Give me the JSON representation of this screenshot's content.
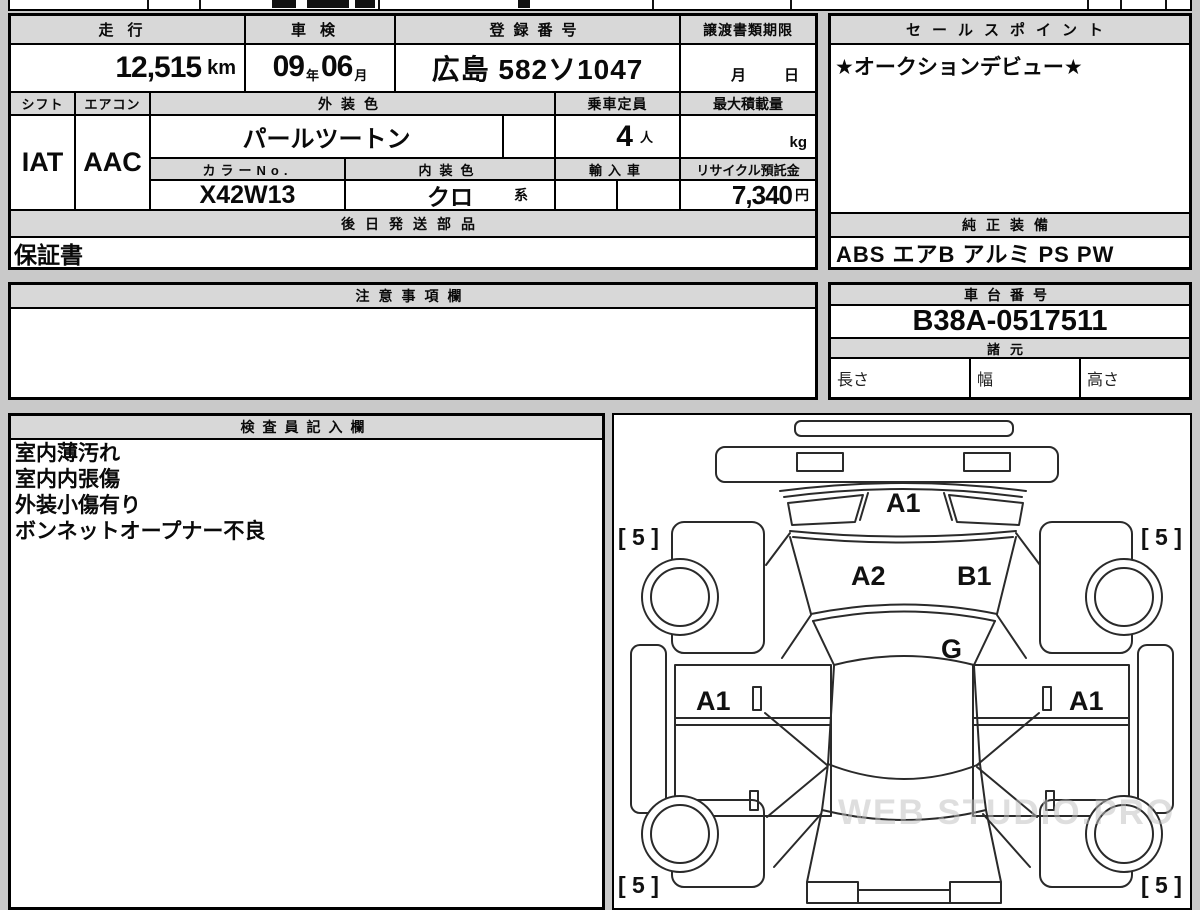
{
  "page": {
    "background": "#c9c9c9",
    "header_bg": "#d8d8d8",
    "border_color": "#000000"
  },
  "main_table": {
    "mileage_label": "走行",
    "mileage_value": "12,515",
    "mileage_unit": "km",
    "shaken_label": "車検",
    "shaken_year": "09",
    "shaken_year_unit": "年",
    "shaken_month": "06",
    "shaken_month_unit": "月",
    "registration_label": "登録番号",
    "registration_value": "広島 582ソ1047",
    "deadline_label": "譲渡書類期限",
    "deadline_month": "月",
    "deadline_day": "日",
    "shift_label": "シフト",
    "shift_value": "IAT",
    "aircon_label": "エアコン",
    "aircon_value": "AAC",
    "exterior_label": "外装色",
    "exterior_value": "パールツートン",
    "capacity_label": "乗車定員",
    "capacity_value": "4",
    "capacity_unit": "人",
    "max_load_label": "最大積載量",
    "max_load_unit": "kg",
    "color_no_label": "カラーNo.",
    "color_no_value": "X42W13",
    "interior_label": "内装色",
    "interior_value": "クロ",
    "interior_suffix": "系",
    "import_label": "輸入車",
    "recycle_label": "リサイクル預託金",
    "recycle_value": "7,340",
    "recycle_unit": "円",
    "later_parts_label": "後日発送部品",
    "later_parts_value": "保証書"
  },
  "sales": {
    "label": "セールスポイント",
    "value": "★オークションデビュー★"
  },
  "equipment": {
    "label": "純正装備",
    "value": "ABS エアB アルミ PS PW"
  },
  "notes": {
    "label": "注意事項欄",
    "value": ""
  },
  "chassis": {
    "label": "車台番号",
    "value": "B38A-0517511"
  },
  "specs": {
    "label": "諸元",
    "length_label": "長さ",
    "width_label": "幅",
    "height_label": "高さ"
  },
  "inspector": {
    "label": "検査員記入欄",
    "lines": [
      "室内薄汚れ",
      "室内内張傷",
      "外装小傷有り",
      "ボンネットオープナー不良"
    ]
  },
  "diagram": {
    "labels": {
      "rear_glass": "A1",
      "trunk_left": "A2",
      "trunk_right": "B1",
      "cowl": "G",
      "door_left": "A1",
      "door_right": "A1"
    },
    "corner_mark": "[ 5 ]",
    "watermark": "WEB STUDIO.PRO"
  }
}
